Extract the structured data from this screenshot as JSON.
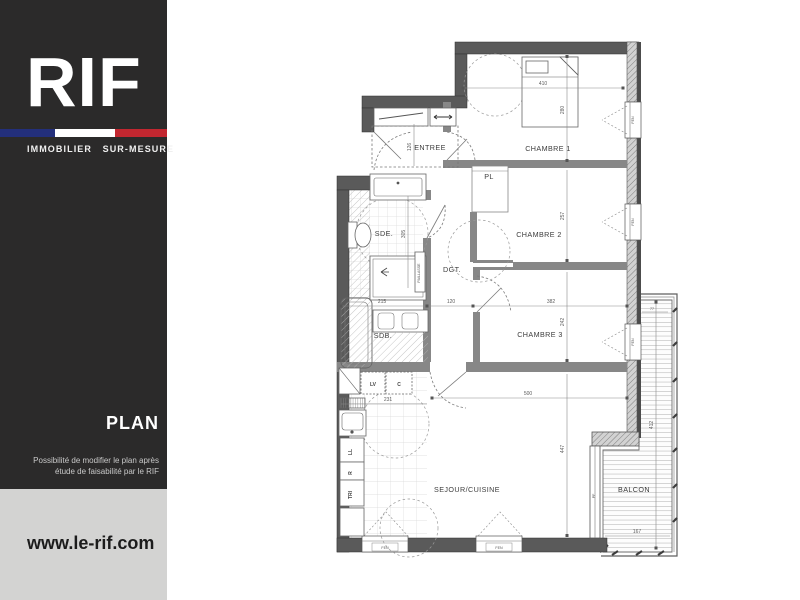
{
  "sidebar": {
    "logo": "RIF",
    "tagline": "IMMOBILIER SUR-MESURE",
    "plan_title": "PLAN",
    "disclaimer1": "Possibilité de modifier le plan après",
    "disclaimer2": "étude de faisabilité par le RIF",
    "website": "www.le-rif.com"
  },
  "colors": {
    "sidebar_dark": "#2B2A2A",
    "sidebar_light": "#D3D3D2",
    "flag_blue": "#232F7B",
    "flag_red": "#C22730",
    "wall_gray": "#5A5A5A"
  },
  "plan": {
    "rooms": {
      "entree": "ENTREE",
      "chambre1": "CHAMBRE 1",
      "chambre2": "CHAMBRE 2",
      "chambre3": "CHAMBRE 3",
      "sde": "SDE.",
      "sdb": "SDB.",
      "dgt": "DGT.",
      "pl": "PL",
      "sejour": "SEJOUR/CUISINE",
      "balcon": "BALCON"
    },
    "dims": {
      "entree_depth": "126",
      "ch1_width": "410",
      "ch1_depth": "280",
      "ch2_depth": "257",
      "ch3_width": "382",
      "ch3_depth": "242",
      "sde_depth": "305",
      "sdb_width": "215",
      "dgt_width": "120",
      "cuisine_width": "231",
      "sejour_width": "500",
      "sejour_depth": "447",
      "balcon_length": "412",
      "balcon_width": "167",
      "balcon_top": "77"
    },
    "appliances": {
      "lv": "LV",
      "c": "C",
      "ll": "LL",
      "r": "R",
      "tri": "TRI",
      "paillasse": "PAILLASSE"
    },
    "openings": {
      "fen": "FEN",
      "pf": "PF"
    }
  }
}
